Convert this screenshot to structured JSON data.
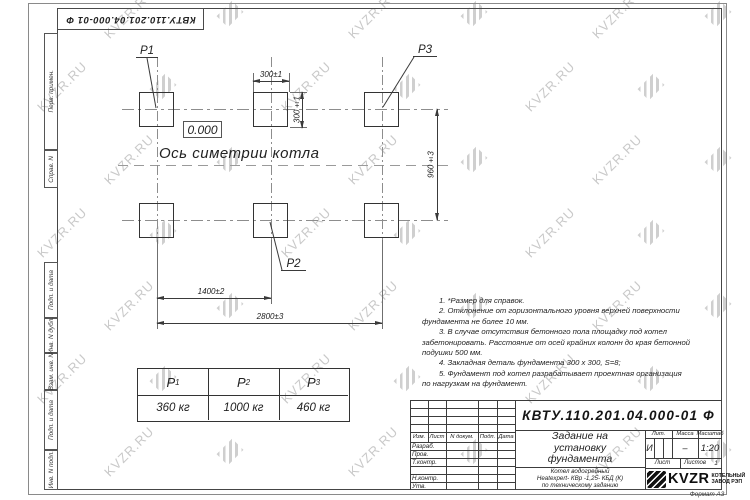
{
  "watermark": {
    "text": "KVZR.RU"
  },
  "colors": {
    "line": "#3a3a3a",
    "watermark": "#c9c9c9",
    "logo": "#121212"
  },
  "stamp_top": {
    "doc_number": "КВТУ.110.201.04.000-01  Ф"
  },
  "side_strip": {
    "labels": [
      "Перв. примен.",
      "Справ. N",
      "Подп. и дата",
      "Инв. N дубл.",
      "Взам. инв. N",
      "Подп. и дата",
      "Инв. N подл."
    ]
  },
  "drawing": {
    "point_labels": {
      "p1": "P1",
      "p2": "P2",
      "p3": "P3"
    },
    "level_mark": "0.000",
    "axis_label": "Ось симетрии котла",
    "dimensions": {
      "pad_width": "300±1",
      "pad_height": "300±1",
      "row_spacing": "960±3",
      "mid_spacing": "1400±2",
      "total_spacing": "2800±3"
    }
  },
  "notes": {
    "lines": [
      "1.  *Размер для справок.",
      "2.  Отклонение от горизонтального уровня верхней поверхности",
      "фундамента не более  10  мм.",
      "3.  В случае отсутствия бетонного пола площадку под котел",
      "забетонировать.  Расстояние от осей крайних колонн до края бетонной",
      "подушки  500  мм.",
      "4.  Закладная деталь фундамента  300 х 300,  S=8;",
      "5.  Фундамент под котел разрабатывает проектная организация",
      "по нагрузкам на фундамент."
    ]
  },
  "load_table": {
    "headers": [
      {
        "base": "P",
        "sub": "1"
      },
      {
        "base": "P",
        "sub": "2"
      },
      {
        "base": "P",
        "sub": "3"
      }
    ],
    "values": [
      "360  кг",
      "1000  кг",
      "460  кг"
    ]
  },
  "title_block": {
    "doc_number": "КВТУ.110.201.04.000-01  Ф",
    "title_lines": [
      "Задание на",
      "установку",
      "фундамента"
    ],
    "subtitle_lines": [
      "Котел водогрейный",
      "Heatexpert- КВр -1,25- КБД (К)",
      "по техническому заданию"
    ],
    "header_cols": [
      "Изм.",
      "Лист",
      "N докум.",
      "Подп.",
      "Дата"
    ],
    "row_labels": [
      "Разраб.",
      "Пров.",
      "Т.контр.",
      "",
      "Н.контр.",
      "Утв."
    ],
    "lit_header": "Лит.",
    "lit_value": "И",
    "mass_header": "Масса",
    "mass_value": "–",
    "scale_header": "Масштаб",
    "scale_value": "1:20",
    "sheet_label": "Лист",
    "sheets_label": "Листов",
    "sheets_value": "1",
    "logo_text": "KVZR",
    "logo_caption_lines": [
      "КОТЕЛЬНЫЙ",
      "ЗАВОД РЭП"
    ],
    "format_label": "Формат А3"
  }
}
